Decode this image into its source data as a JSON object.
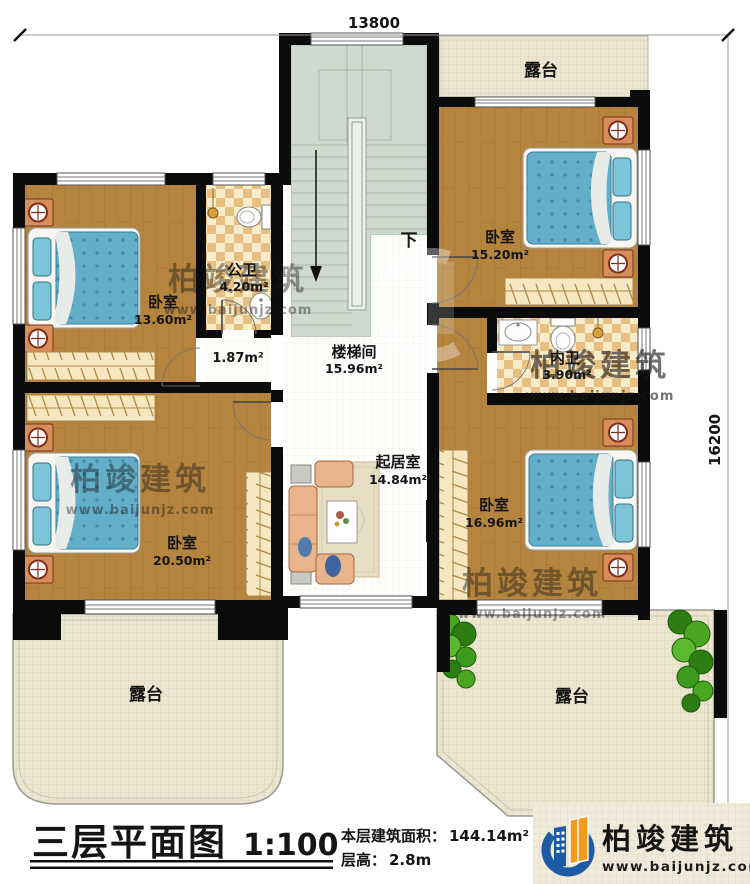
{
  "palette": {
    "wall": "#0b0b0b",
    "wood_floor": "#b5843e",
    "stair_floor": "#cfd9cf",
    "terrace_floor": "#ece6d1",
    "bath_tile": "#e7bf80",
    "bed_blue": "#63aec8",
    "nightstand_orange": "#d68e5c",
    "wardrobe_cream": "#f4e7c1",
    "sofa_peach": "#e9b48c",
    "plant_green": "#3c9a1d",
    "logo_blue": "#1d5ca5",
    "logo_orange": "#f29b1d"
  },
  "dimensions": {
    "top": "13800",
    "right": "16200"
  },
  "rooms": {
    "terrace_top": {
      "name": "露台"
    },
    "bedroom_tr": {
      "name": "卧室",
      "area": "15.20m²"
    },
    "bedroom_tl": {
      "name": "卧室",
      "area": "13.60m²"
    },
    "bath_public": {
      "name": "公卫",
      "area": "4.20m²"
    },
    "hall": {
      "area": "1.87m²"
    },
    "stairwell": {
      "name": "楼梯间",
      "area": "15.96m²",
      "down": "下"
    },
    "bath_private": {
      "name": "内卫",
      "area": "3.90m²"
    },
    "living": {
      "name": "起居室",
      "area": "14.84m²"
    },
    "bedroom_bl": {
      "name": "卧室",
      "area": "20.50m²"
    },
    "bedroom_br": {
      "name": "卧室",
      "area": "16.96m²"
    },
    "terrace_bl": {
      "name": "露台"
    },
    "terrace_br": {
      "name": "露台"
    }
  },
  "footer": {
    "title": "三层平面图",
    "scale": "1:100",
    "area_label": "本层建筑面积：",
    "area_value": "144.14m²",
    "height_label": "层高：",
    "height_value": "2.8m"
  },
  "brand": {
    "name": "柏竣建筑",
    "website": "www.baijunjz.com"
  },
  "watermark": {
    "name": "柏竣建筑",
    "website": "www.baijunjz.com"
  }
}
